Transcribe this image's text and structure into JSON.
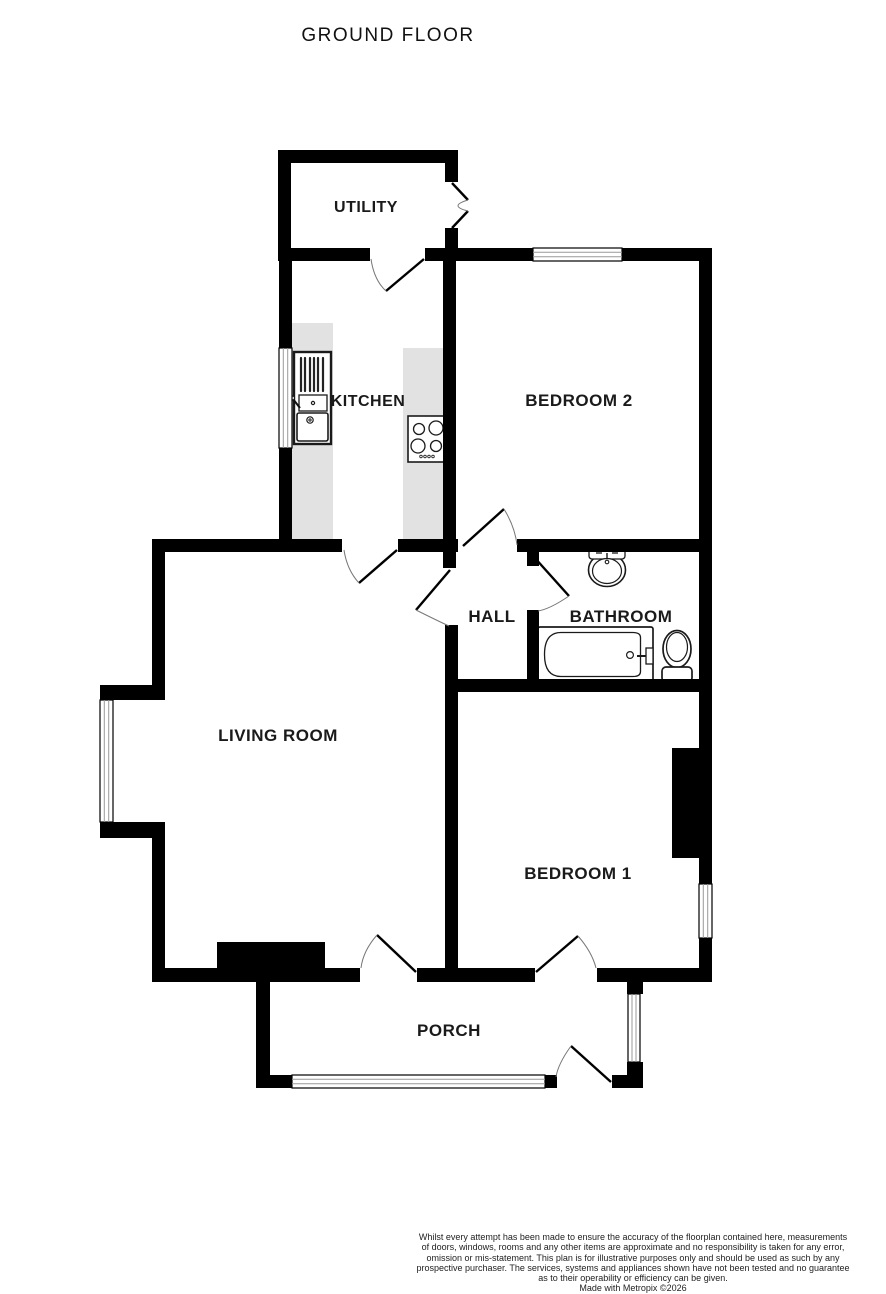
{
  "title": "GROUND FLOOR",
  "rooms": {
    "utility": "UTILITY",
    "kitchen": "KITCHEN",
    "bedroom2": "BEDROOM 2",
    "hall": "HALL",
    "bathroom": "BATHROOM",
    "living_room": "LIVING ROOM",
    "bedroom1": "BEDROOM 1",
    "porch": "PORCH"
  },
  "icons": {
    "kitchen_sink": "sink-and-drainer-icon",
    "hob": "four-ring-hob-icon",
    "basin": "washbasin-icon",
    "bath": "bathtub-icon",
    "toilet": "toilet-icon"
  },
  "colors": {
    "wall": "#000000",
    "counter": "#e2e2e2",
    "background": "#ffffff",
    "door_arc": "#777777",
    "window_line": "#999999",
    "text": "#1a1a1a"
  },
  "footer": {
    "disclaimer_lines": [
      "Whilst every attempt has been made to ensure the accuracy of the floorplan contained here, measurements",
      "of doors, windows, rooms and any other items are approximate and no responsibility is taken for any error,",
      "omission or mis-statement. This plan is for illustrative purposes only and should be used as such by any",
      "prospective purchaser. The services, systems and appliances shown have not been tested and no guarantee",
      "as to their operability or efficiency can be given."
    ],
    "credit": "Made with Metropix ©2026"
  }
}
